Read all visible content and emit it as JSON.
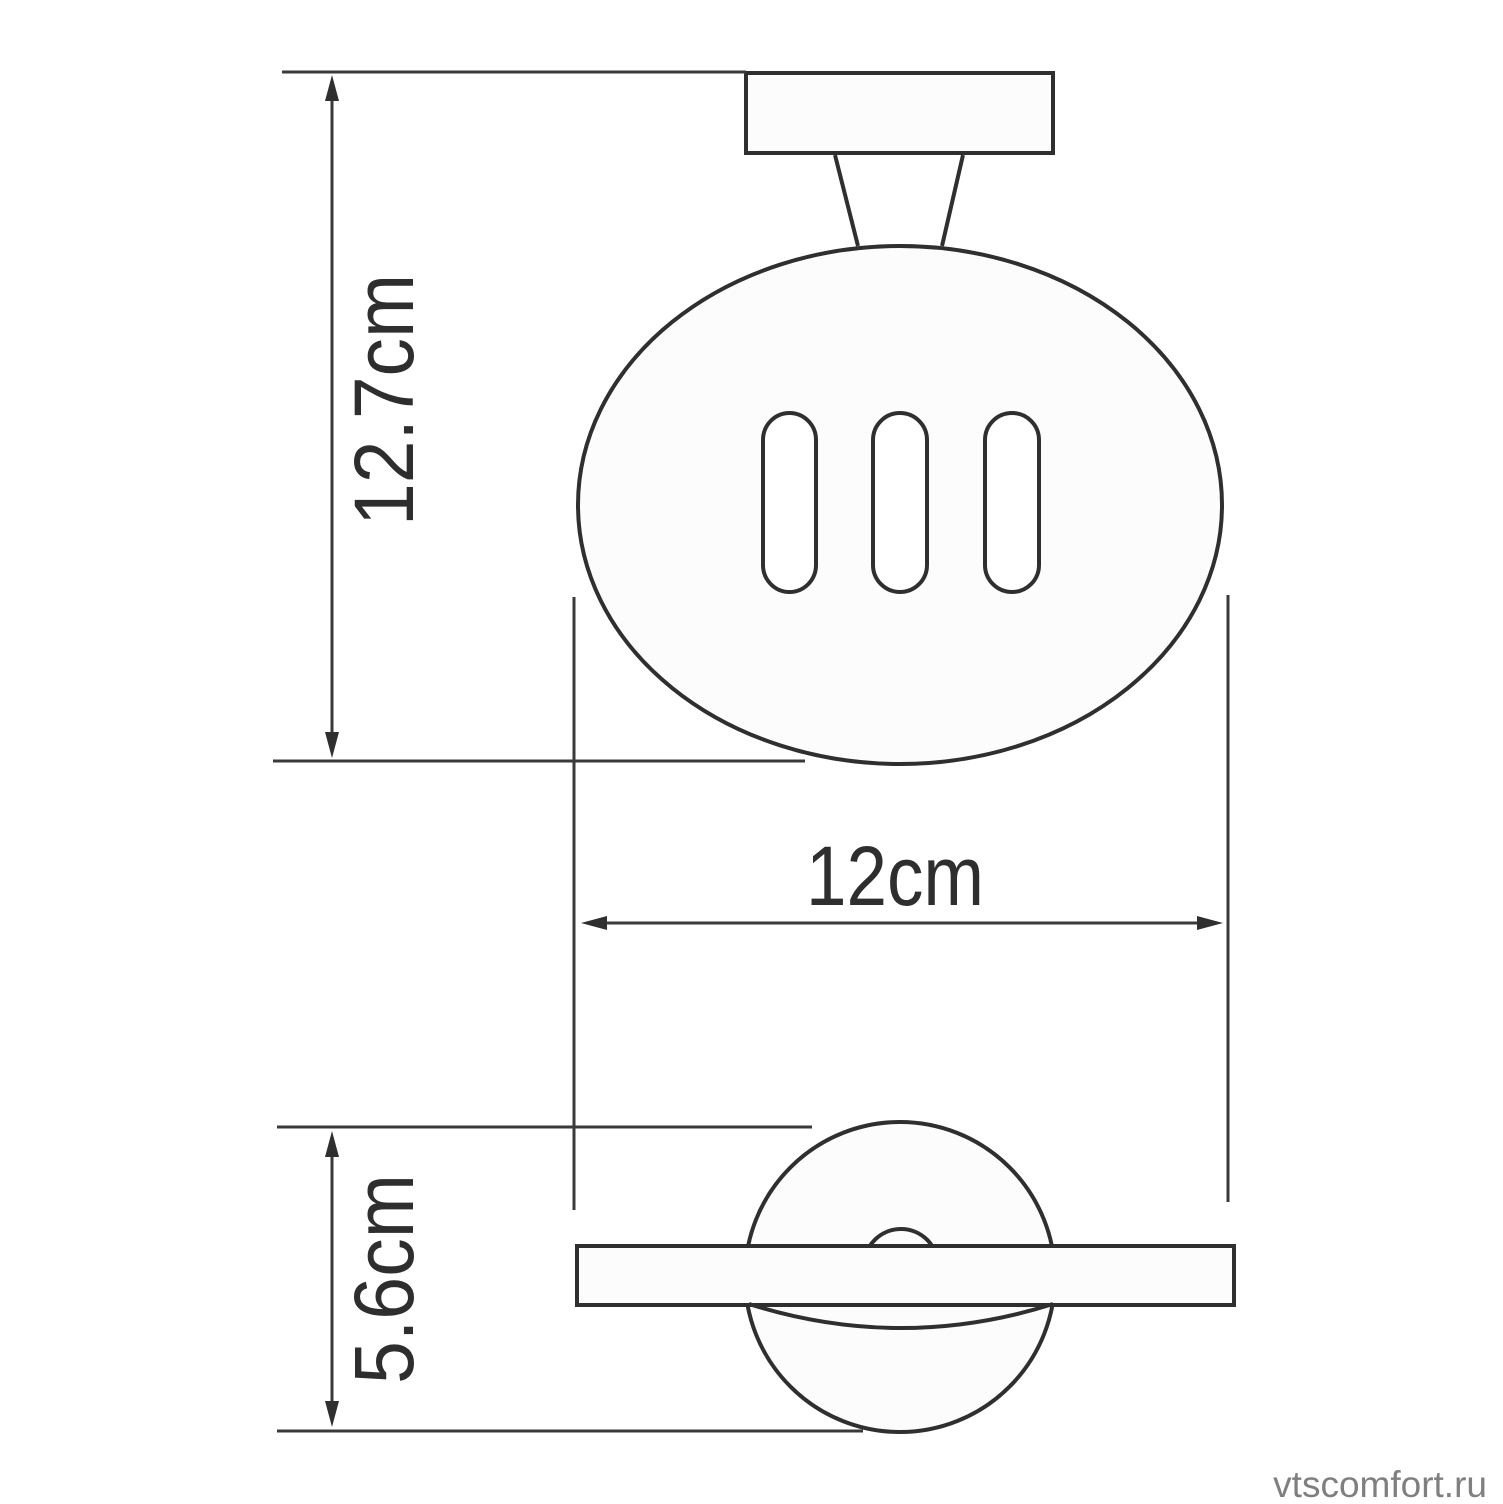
{
  "diagram": {
    "type": "technical-dimension-drawing",
    "subject": "wall-mounted soap dish holder",
    "views": {
      "front_view": "top drawing: mounting plate, stem and slotted oval soap dish",
      "side_view": "bottom drawing: round wall disc crossed by dish profile bar"
    },
    "dimensions": [
      {
        "id": "height",
        "label": "12.7cm",
        "value_cm": 12.7,
        "orientation": "vertical",
        "measures": "overall height from top of mounting plate to bottom of dish"
      },
      {
        "id": "width",
        "label": "12cm",
        "value_cm": 12.0,
        "orientation": "horizontal",
        "measures": "dish width"
      },
      {
        "id": "depth",
        "label": "5.6cm",
        "value_cm": 5.6,
        "orientation": "vertical",
        "measures": "wall disc diameter / projection depth"
      }
    ],
    "drain_slot_count": 3,
    "watermark": "vtscomfort.ru",
    "colors": {
      "line": "#2f2f2f",
      "thin_line": "#3a3a3a",
      "shape_fill": "#fcfcfc",
      "label_text": "#2e2e2e",
      "watermark_text": "#7f7f7f",
      "background": "#ffffff"
    }
  }
}
